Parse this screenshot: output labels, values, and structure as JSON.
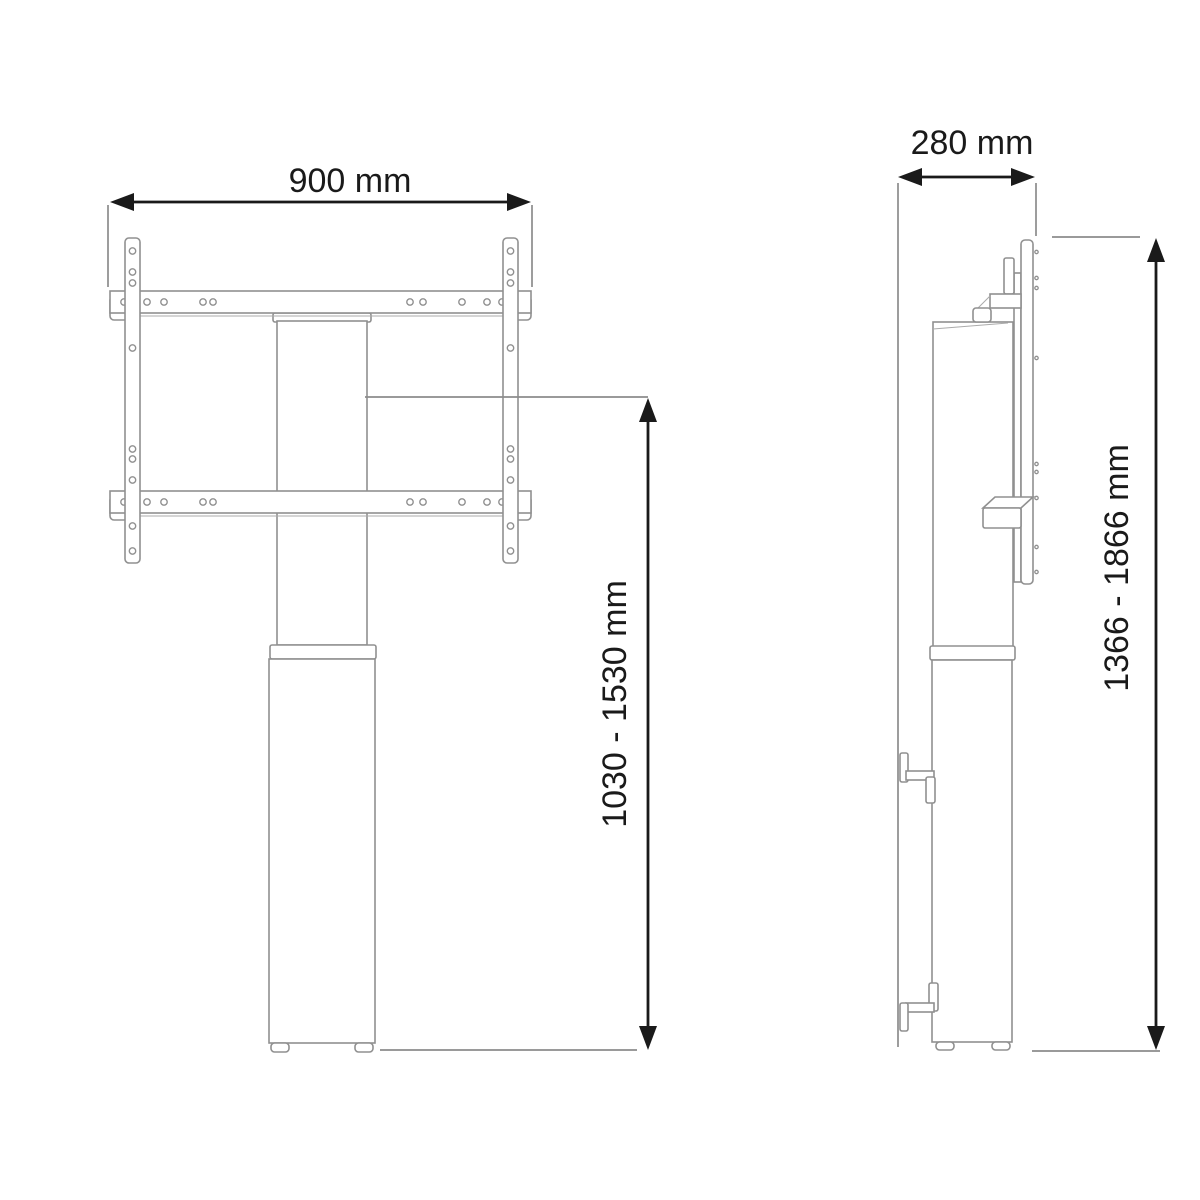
{
  "colors": {
    "canvas": "#ffffff",
    "outline": "#909090",
    "outline_light": "#ababab",
    "extension": "#8c8c8c",
    "dimension": "#1a1a1a"
  },
  "front_view": {
    "width_dimension": "900 mm",
    "height_dimension": "1030 - 1530 mm"
  },
  "side_view": {
    "depth_dimension": "280 mm",
    "height_dimension": "1366 - 1866 mm"
  }
}
